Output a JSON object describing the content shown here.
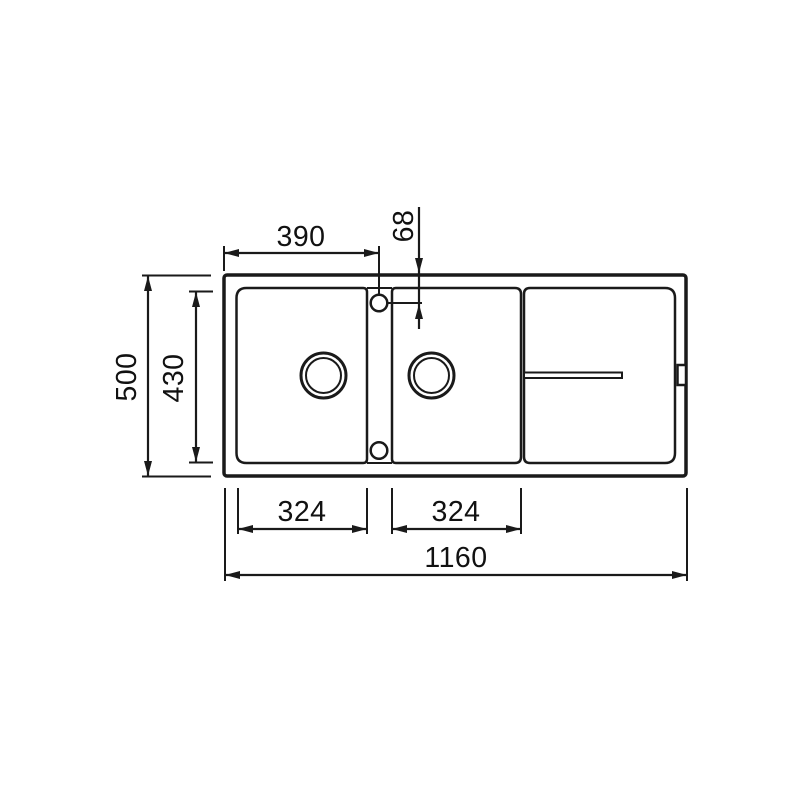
{
  "diagram": {
    "type": "technical-drawing",
    "subject": "double-bowl kitchen sink with drainer, top view",
    "background_color": "#ffffff",
    "line_color": "#1a1a1a",
    "features": {
      "outline": "sink outer rim",
      "left_bowl": "left sink bowl with drain hole",
      "right_bowl": "right sink bowl with drain hole",
      "drainer": "drainer board area with groove",
      "tap_holes": "two tap holes on centre divider",
      "overflow": "overflow outlet on right rim"
    },
    "dimensions": [
      {
        "id": "tap-hole-offset-x",
        "label": "390",
        "orientation": "horizontal",
        "unit": "mm"
      },
      {
        "id": "tap-hole-offset-y",
        "label": "68",
        "orientation": "vertical",
        "unit": "mm"
      },
      {
        "id": "overall-depth",
        "label": "500",
        "orientation": "vertical",
        "unit": "mm"
      },
      {
        "id": "bowl-depth",
        "label": "430",
        "orientation": "vertical",
        "unit": "mm"
      },
      {
        "id": "left-bowl-width",
        "label": "324",
        "orientation": "horizontal",
        "unit": "mm"
      },
      {
        "id": "right-bowl-width",
        "label": "324",
        "orientation": "horizontal",
        "unit": "mm"
      },
      {
        "id": "overall-width",
        "label": "1160",
        "orientation": "horizontal",
        "unit": "mm"
      }
    ]
  }
}
